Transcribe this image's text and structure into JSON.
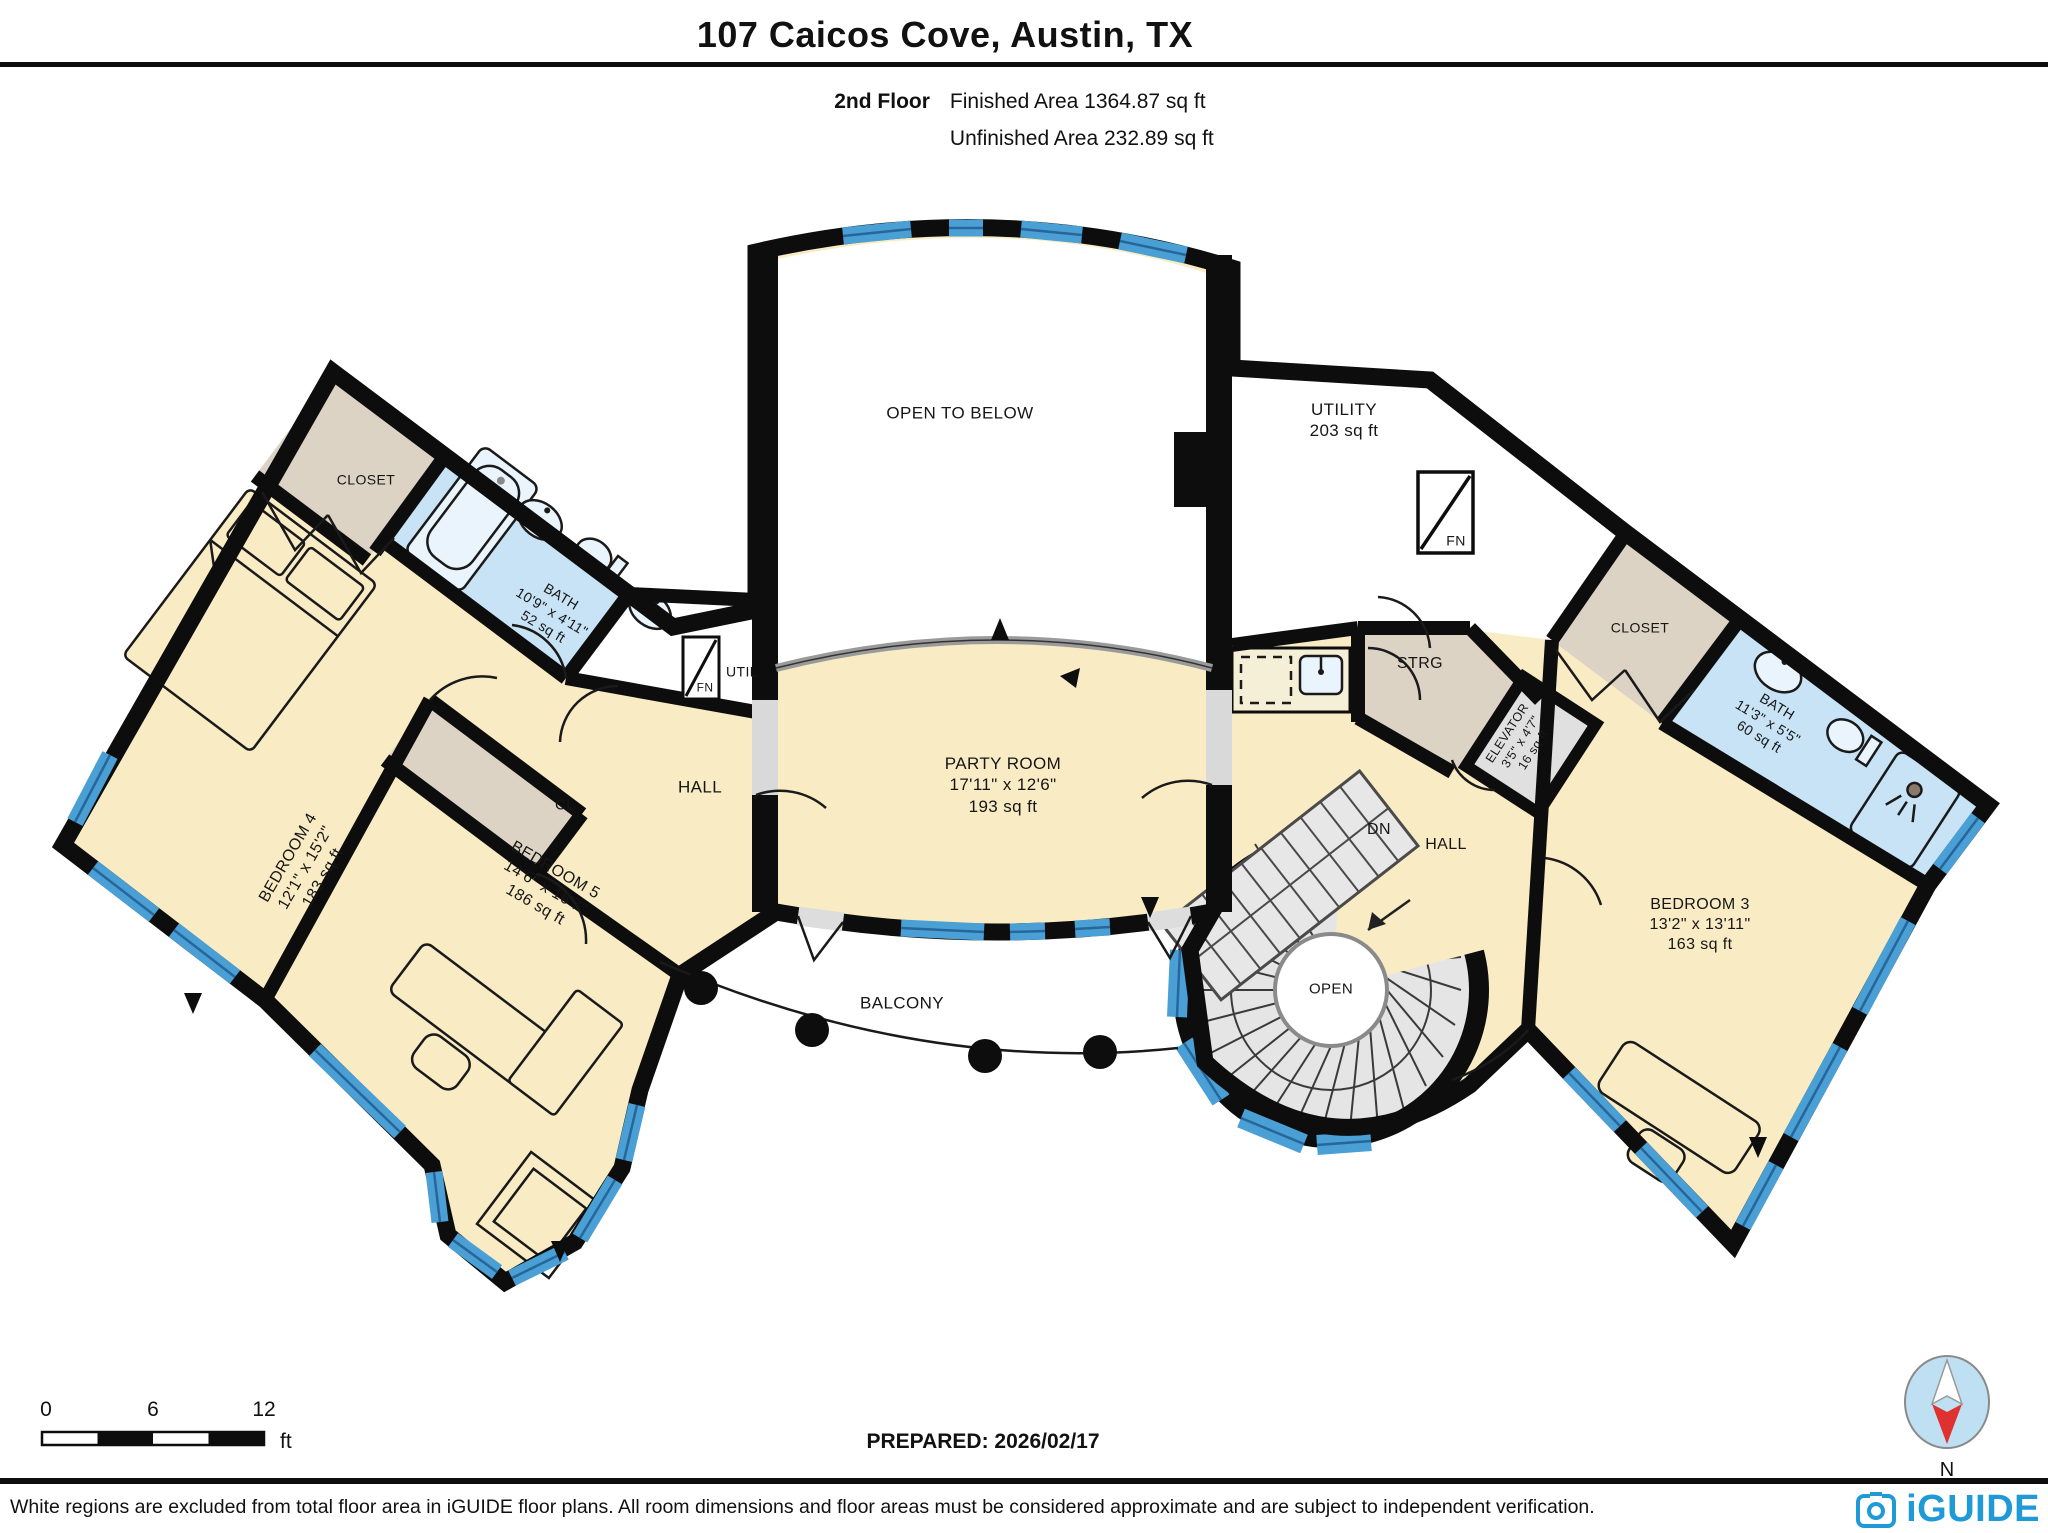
{
  "header": {
    "title": "107 Caicos Cove, Austin, TX",
    "floor": "2nd Floor",
    "finished": "Finished Area 1364.87 sq ft",
    "unfinished": "Unfinished Area 232.89 sq ft"
  },
  "rooms": {
    "open_below": {
      "name": "OPEN TO BELOW"
    },
    "utility": {
      "name": "UTILITY",
      "area": "203 sq ft"
    },
    "party": {
      "name": "PARTY ROOM",
      "dims": "17'11\" x 12'6\"",
      "area": "193 sq ft"
    },
    "bedroom4": {
      "name": "BEDROOM 4",
      "dims": "12'1\" x 15'2\"",
      "area": "183 sq ft"
    },
    "bedroom5": {
      "name": "BEDROOM 5",
      "dims": "14'6\" x 16'7\"",
      "area": "186 sq ft"
    },
    "bedroom3": {
      "name": "BEDROOM 3",
      "dims": "13'2\" x 13'11\"",
      "area": "163 sq ft"
    },
    "bath_left": {
      "name": "BATH",
      "dims": "10'9\" x 4'11\"",
      "area": "52 sq ft"
    },
    "bath_right": {
      "name": "BATH",
      "dims": "11'3\" x 5'5\"",
      "area": "60 sq ft"
    },
    "elevator": {
      "name": "ELEVATOR",
      "dims": "3'5\" x 4'7\"",
      "area": "16 sq ft"
    },
    "closet_left": {
      "name": "CLOSET"
    },
    "closet_right": {
      "name": "CLOSET"
    },
    "cl": {
      "name": "CL"
    },
    "hall_left": {
      "name": "HALL"
    },
    "hall_right": {
      "name": "HALL"
    },
    "util": {
      "name": "UTIL"
    },
    "fn": {
      "name": "FN"
    },
    "strg": {
      "name": "STRG"
    },
    "dn": {
      "name": "DN"
    },
    "open": {
      "name": "OPEN"
    },
    "balcony": {
      "name": "BALCONY"
    }
  },
  "scalebar": {
    "t0": "0",
    "t6": "6",
    "t12": "12",
    "unit": "ft"
  },
  "footer": {
    "prepared": "PREPARED: 2026/02/17",
    "disclaimer": "White regions are excluded from total floor area in iGUIDE floor plans. All room dimensions and floor areas must be considered approximate and are subject to independent verification.",
    "brand": "iGUIDE",
    "compass_n": "N"
  },
  "colors": {
    "room_fill": "#F9ECC5",
    "bath_fill": "#C7E3F5",
    "closet_fill": "#DCD3C4",
    "window_blue": "#4A9FD4",
    "wall": "#0d0d0d",
    "stair_gray": "#E5E5E5",
    "logo_blue": "#1F9AD6",
    "compass_red": "#E03131"
  }
}
